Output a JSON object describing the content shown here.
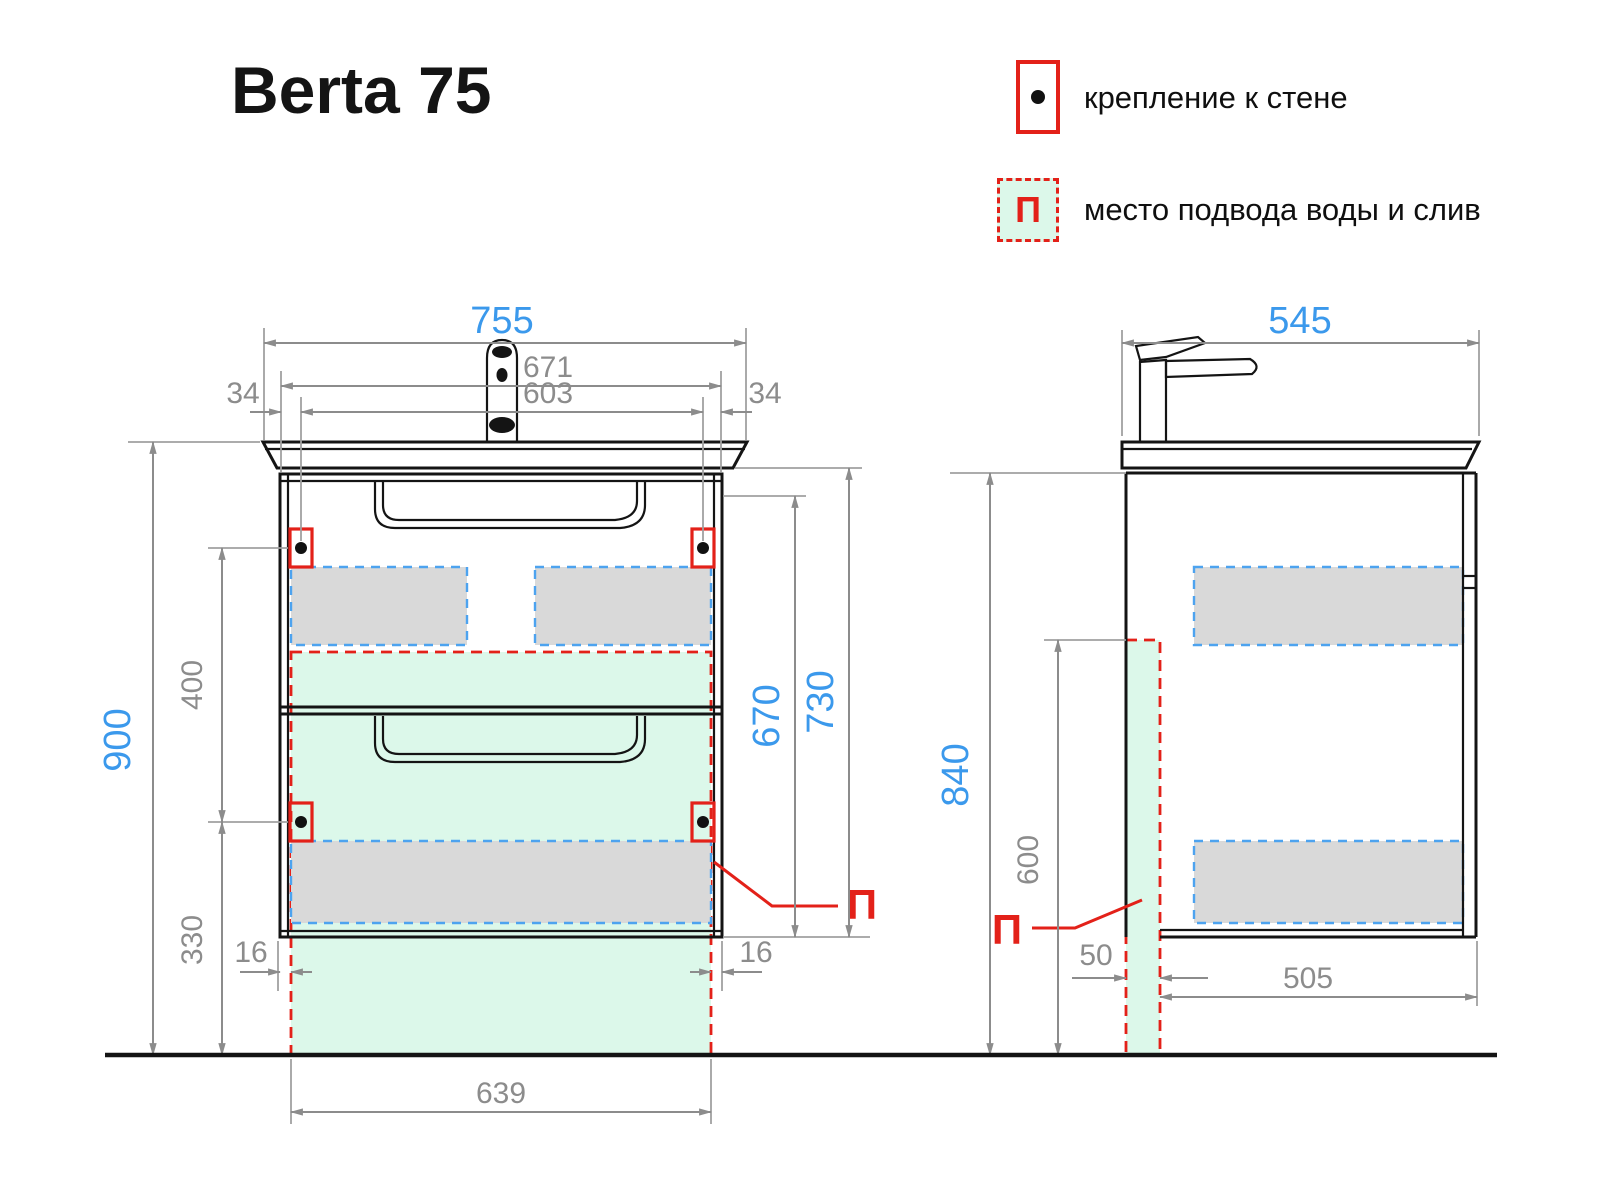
{
  "title": "Berta 75",
  "legend": {
    "wall_mount_label": "крепление к стене",
    "water_supply_label": "место подвода воды и слив",
    "p_symbol": "П"
  },
  "front_view": {
    "total_width": "755",
    "cabinet_width": "671",
    "mount_spacing": "603",
    "side_offset_left": "34",
    "side_offset_right": "34",
    "total_height": "900",
    "mount_gap": "400",
    "mount_floor_height": "330",
    "green_offset_left": "16",
    "green_offset_right": "16",
    "green_width": "639",
    "drawer_stack_height": "670",
    "cabinet_height": "730",
    "p_symbol": "П"
  },
  "side_view": {
    "total_depth": "545",
    "cabinet_height": "840",
    "supply_height": "600",
    "supply_depth": "50",
    "inner_depth": "505",
    "p_symbol": "П"
  },
  "colors": {
    "accent_blue": "#3b99ec",
    "accent_red": "#e32119",
    "zone_green": "#dcf8ea",
    "slide_gray": "#d9d9d9",
    "dash_blue": "#4da3ef",
    "dim_gray": "#8c8c8c"
  }
}
